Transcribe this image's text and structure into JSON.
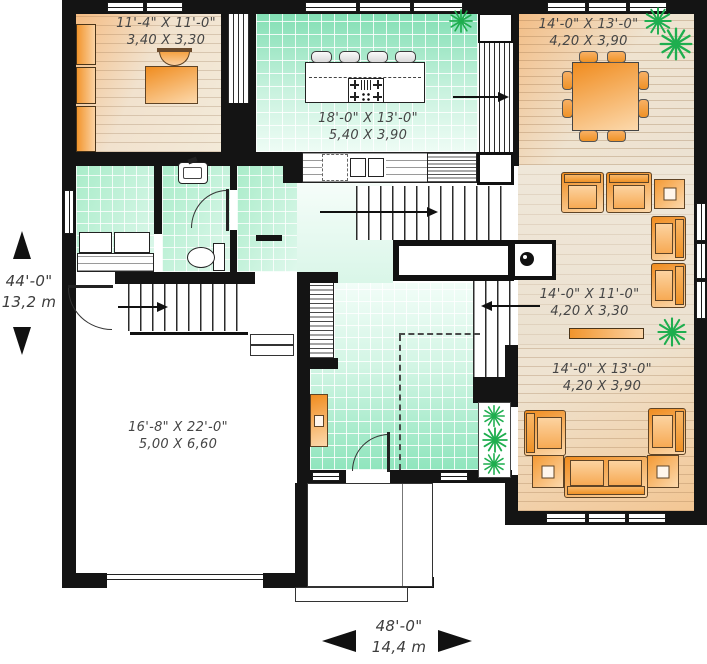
{
  "plan_title": "House first-floor plan",
  "rooms": {
    "office": {
      "imperial": "11'-4\" X 11'-0\"",
      "metric": "3,40 X 3,30"
    },
    "kitchen": {
      "imperial": "18'-0\" X 13'-0\"",
      "metric": "5,40 X 3,90"
    },
    "dining": {
      "imperial": "14'-0\" X 13'-0\"",
      "metric": "4,20 X 3,90"
    },
    "living": {
      "imperial": "14'-0\" X 11'-0\"",
      "metric": "4,20 X 3,30"
    },
    "family": {
      "imperial": "14'-0\" X 13'-0\"",
      "metric": "4,20 X 3,90"
    },
    "garage": {
      "imperial": "16'-8\" X 22'-0\"",
      "metric": "5,00 X 6,60"
    }
  },
  "overall_dimensions": {
    "depth": {
      "imperial": "44'-0\"",
      "metric": "13,2 m"
    },
    "width": {
      "imperial": "48'-0\"",
      "metric": "14,4 m"
    }
  },
  "colors": {
    "wall": "#141414",
    "furniture_orange": "#f08c1f",
    "tile_green": "#8fe5bd",
    "wood_beige": "#efe3d0",
    "plant_green": "#1fae4f"
  }
}
